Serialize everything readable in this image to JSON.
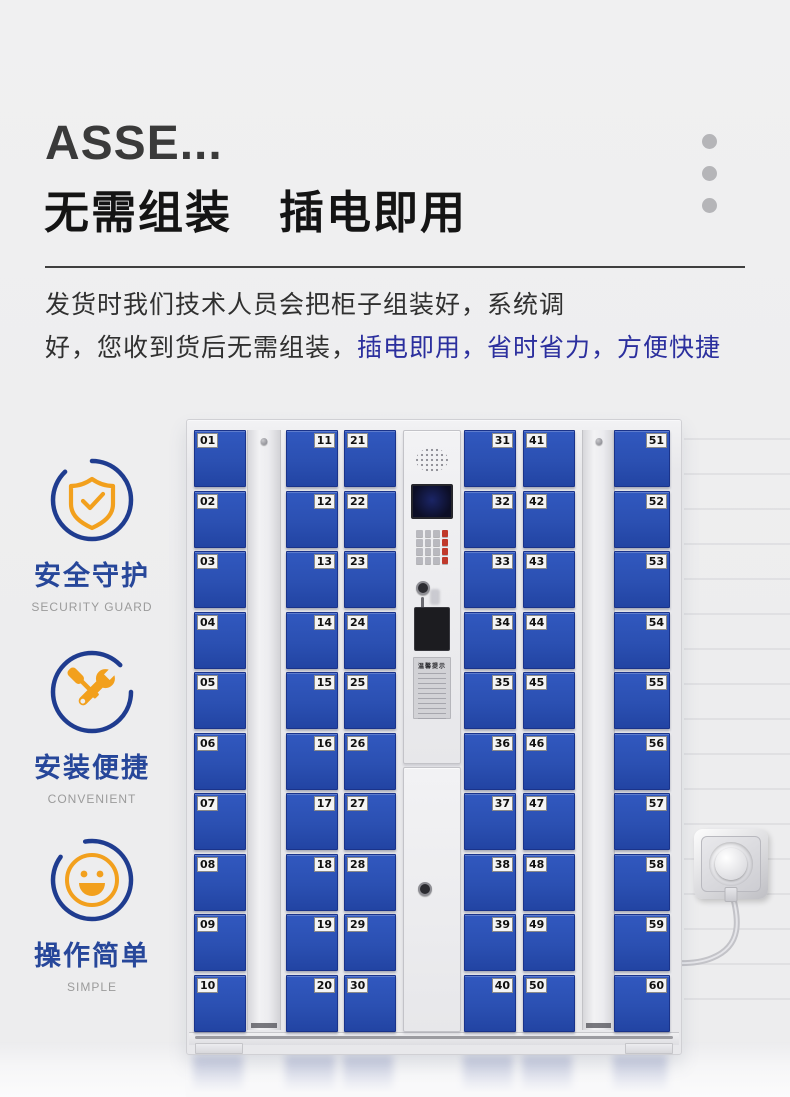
{
  "header": {
    "title_en": "ASSE...",
    "title_cn": "无需组装　插电即用",
    "paragraph": {
      "line1": "发货时我们技术人员会把柜子组装好，系统调",
      "line2_dark": "好，您收到货后无需组装，",
      "line2_blue": "插电即用，省时省力，方便快捷"
    },
    "highlight_color": "#2b2f9e"
  },
  "features": [
    {
      "icon": "shield-check-icon",
      "label": "安全守护",
      "caption": "SECURITY GUARD"
    },
    {
      "icon": "tools-icon",
      "label": "安装便捷",
      "caption": "CONVENIENT"
    },
    {
      "icon": "smiley-icon",
      "label": "操作简单",
      "caption": "SIMPLE"
    }
  ],
  "colors": {
    "door_blue": "#2b50b2",
    "icon_circle_blue": "#1f3c8f",
    "icon_orange": "#f2a01d"
  },
  "locker": {
    "columns": [
      {
        "kind": "doors",
        "label_side": "left",
        "numbers": [
          "01",
          "02",
          "03",
          "04",
          "05",
          "06",
          "07",
          "08",
          "09",
          "10"
        ]
      },
      {
        "kind": "strip"
      },
      {
        "kind": "doors",
        "label_side": "right",
        "numbers": [
          "11",
          "12",
          "13",
          "14",
          "15",
          "16",
          "17",
          "18",
          "19",
          "20"
        ]
      },
      {
        "kind": "doors",
        "label_side": "left",
        "numbers": [
          "21",
          "22",
          "23",
          "24",
          "25",
          "26",
          "27",
          "28",
          "29",
          "30"
        ]
      },
      {
        "kind": "control"
      },
      {
        "kind": "doors",
        "label_side": "right",
        "numbers": [
          "31",
          "32",
          "33",
          "34",
          "35",
          "36",
          "37",
          "38",
          "39",
          "40"
        ]
      },
      {
        "kind": "doors",
        "label_side": "left",
        "numbers": [
          "41",
          "42",
          "43",
          "44",
          "45",
          "46",
          "47",
          "48",
          "49",
          "50"
        ]
      },
      {
        "kind": "strip"
      },
      {
        "kind": "doors",
        "label_side": "right",
        "numbers": [
          "51",
          "52",
          "53",
          "54",
          "55",
          "56",
          "57",
          "58",
          "59",
          "60"
        ]
      }
    ],
    "control": {
      "sticker_title": "温馨提示"
    }
  }
}
